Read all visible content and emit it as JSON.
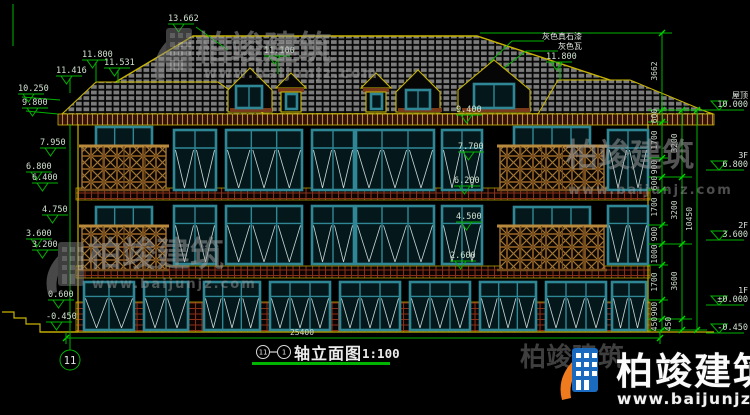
{
  "watermark": {
    "brand": "柏竣建筑",
    "url": "www.baijunjz.com"
  },
  "title": {
    "axis_a": "11",
    "axis_b": "1",
    "name": "轴立面图",
    "scale": "1:100"
  },
  "axis_bubble": "11",
  "notes": {
    "paint": "灰色真石漆",
    "tile": "灰色瓦"
  },
  "roof_labels": {
    "peak": "13.662",
    "mid": "11.800",
    "sub": "11.531",
    "sub2": "11.416",
    "eave_l": "10.250",
    "eave_l2": "9.800",
    "turret": "11.100",
    "right": "11.800"
  },
  "left_labels": [
    "7.950",
    "6.800",
    "6.400",
    "4.750",
    "3.600",
    "3.200",
    "0.600",
    "-0.450"
  ],
  "mid_labels": [
    "9.400",
    "7.700",
    "6.200",
    "4.500",
    "2.600"
  ],
  "right_markers": [
    {
      "name": "屋顶",
      "value": "10.000"
    },
    {
      "name": "3F",
      "value": "6.800"
    },
    {
      "name": "2F",
      "value": "3.600"
    },
    {
      "name": "1F",
      "value": "±0.000"
    },
    {
      "name": "",
      "value": "-0.450"
    }
  ],
  "dims": {
    "roof_rise": "3662",
    "small": [
      "600",
      "1700",
      "900",
      "600",
      "1700",
      "900",
      "1000",
      "1700",
      "900",
      "450"
    ],
    "floors": [
      "3200",
      "3200",
      "3600",
      "450"
    ],
    "total": "10450",
    "width": "25400"
  }
}
